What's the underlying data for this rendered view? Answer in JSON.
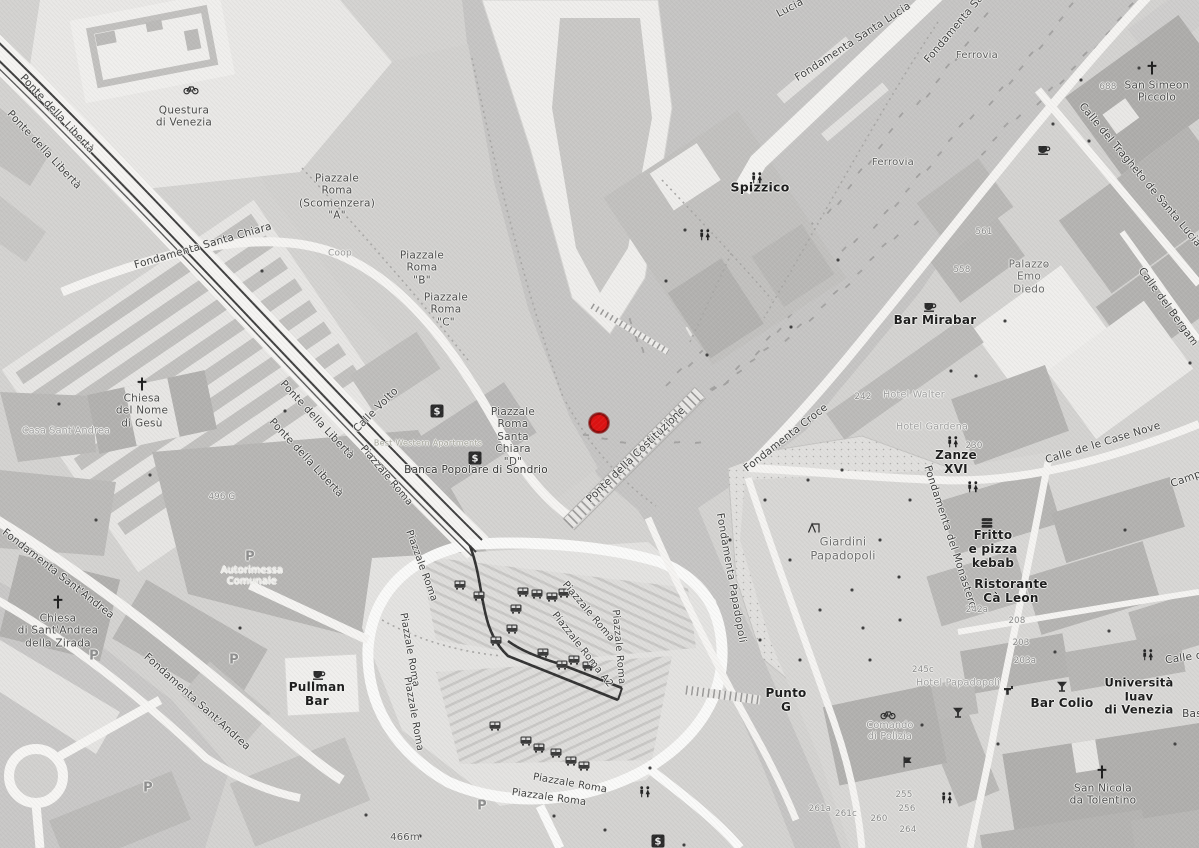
{
  "map": {
    "description": "Grayscale street map of Venice, Piazzale Roma and Santa Lucia area, with red location marker on the canal basin",
    "colors": {
      "land": "#d4d3d1",
      "water": "#c6c5c4",
      "building": "#b5b4b2",
      "building_light": "#efeeec",
      "road": "#f7f6f4",
      "park": "#e1e0de",
      "rail": "#404040",
      "marker_red": "#dd1212",
      "marker_ring": "#8f0b0b"
    },
    "marker": {
      "x": 599,
      "y": 423,
      "color": "#dd1212"
    },
    "scale_label": "466m",
    "labels": [
      {
        "t": "Lucia",
        "x": 790,
        "y": 8,
        "r": -28
      },
      {
        "t": "Fondamenta Santa Lucia",
        "x": 853,
        "y": 42,
        "r": -33
      },
      {
        "t": "Fondamenta Sa",
        "x": 954,
        "y": 29,
        "r": -50
      },
      {
        "t": "Ferrovia",
        "x": 977,
        "y": 56,
        "s": 10,
        "c": "#5a5a5a"
      },
      {
        "t": "Ferrovia",
        "x": 893,
        "y": 163,
        "s": 10,
        "c": "#5a5a5a"
      },
      {
        "t": "Spizzico",
        "x": 760,
        "y": 188,
        "s": 12.5,
        "w": 700,
        "c": "#1c1c1c"
      },
      {
        "t": "Questura\ndi Venezia",
        "x": 184,
        "y": 117,
        "c": "#4a4a4a"
      },
      {
        "t": "Piazzale\nRoma\n(Scomenzera)\n\"A\"",
        "x": 337,
        "y": 197,
        "c": "#4a4a4a"
      },
      {
        "t": "Piazzale\nRoma\n\"B\"",
        "x": 422,
        "y": 268,
        "c": "#4a4a4a"
      },
      {
        "t": "Piazzale\nRoma\n\"C\"",
        "x": 446,
        "y": 310,
        "c": "#4a4a4a"
      },
      {
        "t": "Piazzale\nRoma\nSanta\nChiara\n\"D\"",
        "x": 513,
        "y": 437,
        "c": "#4a4a4a"
      },
      {
        "t": "Fondamenta Santa Chiara",
        "x": 203,
        "y": 246,
        "r": -16
      },
      {
        "t": "Ponte della Libertà",
        "x": 57,
        "y": 114,
        "r": 47
      },
      {
        "t": "Ponte della Libertà",
        "x": 44,
        "y": 150,
        "r": 47
      },
      {
        "t": "Ponte della Libertà",
        "x": 317,
        "y": 420,
        "r": 47
      },
      {
        "t": "Ponte della Libertà",
        "x": 306,
        "y": 458,
        "r": 47
      },
      {
        "t": "Piazzale Roma",
        "x": 386,
        "y": 476,
        "r": 50,
        "s": 10
      },
      {
        "t": "Piazzale Roma",
        "x": 421,
        "y": 566,
        "r": 70,
        "s": 10
      },
      {
        "t": "Piazzale Roma",
        "x": 409,
        "y": 650,
        "r": 80,
        "s": 10
      },
      {
        "t": "Piazzale Roma",
        "x": 413,
        "y": 714,
        "r": 80,
        "s": 10
      },
      {
        "t": "Piazzale Roma",
        "x": 588,
        "y": 612,
        "r": 50,
        "s": 10
      },
      {
        "t": "Piazzale Roma A2",
        "x": 582,
        "y": 650,
        "r": 52,
        "s": 10
      },
      {
        "t": "Piazzale Roma",
        "x": 618,
        "y": 647,
        "r": 85,
        "s": 10
      },
      {
        "t": "Piazzale Roma",
        "x": 570,
        "y": 784,
        "r": 10,
        "s": 10
      },
      {
        "t": "Piazzale Roma",
        "x": 549,
        "y": 798,
        "r": 8,
        "s": 10
      },
      {
        "t": "Calle Volto",
        "x": 376,
        "y": 410,
        "r": -45
      },
      {
        "t": "Coop",
        "x": 340,
        "y": 254,
        "s": 9,
        "c": "#9a9a9a"
      },
      {
        "t": "Best Western Apartments",
        "x": 428,
        "y": 443,
        "s": 8,
        "c": "#a8a89e"
      },
      {
        "t": "Banca Popolare di Sondrio",
        "x": 476,
        "y": 470,
        "c": "#333333"
      },
      {
        "t": "Ponte della Costituzione",
        "x": 636,
        "y": 455,
        "r": -44
      },
      {
        "t": "Fondamenta Croce",
        "x": 786,
        "y": 438,
        "r": -38
      },
      {
        "t": "Fondamenta Papadopoli",
        "x": 731,
        "y": 578,
        "r": 80
      },
      {
        "t": "Fondamenta del Monastero",
        "x": 950,
        "y": 537,
        "r": 72
      },
      {
        "t": "Giardini\nPapadopoli",
        "x": 843,
        "y": 549,
        "s": 11.5,
        "c": "#6e6e6e"
      },
      {
        "t": "242",
        "x": 863,
        "y": 397,
        "s": 8.5,
        "c": "#8a8a8a"
      },
      {
        "t": "Hotel Walter",
        "x": 914,
        "y": 395,
        "s": 9.5,
        "c": "#a0a0a0"
      },
      {
        "t": "Hotel Gardena",
        "x": 932,
        "y": 427,
        "s": 9.5,
        "c": "#a0a0a0"
      },
      {
        "t": "Zanze\nXVI",
        "x": 956,
        "y": 462,
        "s": 12,
        "w": 700,
        "c": "#1c1c1c"
      },
      {
        "t": "230",
        "x": 974,
        "y": 446,
        "s": 8.5,
        "c": "#8a8a8a"
      },
      {
        "t": "Bar Mirabar",
        "x": 935,
        "y": 320,
        "s": 12,
        "w": 700,
        "c": "#1c1c1c"
      },
      {
        "t": "Palazzo\nEmo\nDiedo",
        "x": 1029,
        "y": 277,
        "c": "#6a6a6a"
      },
      {
        "t": "558",
        "x": 962,
        "y": 270,
        "s": 8.5,
        "c": "#8a8a8a"
      },
      {
        "t": "561",
        "x": 984,
        "y": 232,
        "s": 8.5,
        "c": "#8a8a8a"
      },
      {
        "t": "San Simeon\nPiccolo",
        "x": 1157,
        "y": 92,
        "c": "#4a4a4a"
      },
      {
        "t": "688",
        "x": 1108,
        "y": 87,
        "s": 8.5,
        "c": "#8a8a8a"
      },
      {
        "t": "Calle del Tragheto de Santa Lucia",
        "x": 1140,
        "y": 175,
        "r": 50
      },
      {
        "t": "Calle del Bergam",
        "x": 1168,
        "y": 307,
        "r": 54
      },
      {
        "t": "Calle de le Case Nove",
        "x": 1103,
        "y": 443,
        "r": -17
      },
      {
        "t": "Campo",
        "x": 1189,
        "y": 478,
        "r": -20
      },
      {
        "t": "Fritto\ne pizza\nkebab",
        "x": 993,
        "y": 549,
        "s": 12,
        "w": 700,
        "c": "#1c1c1c"
      },
      {
        "t": "Ristorante\nCà Leon",
        "x": 1011,
        "y": 591,
        "s": 12,
        "w": 700,
        "c": "#1c1c1c"
      },
      {
        "t": "242a",
        "x": 977,
        "y": 610,
        "s": 8.5,
        "c": "#8a8a8a"
      },
      {
        "t": "Università\nIuav\ndi Venezia",
        "x": 1139,
        "y": 697,
        "s": 11.5,
        "w": 700,
        "c": "#1c1c1c"
      },
      {
        "t": "Bar Colio",
        "x": 1062,
        "y": 703,
        "s": 12,
        "w": 700,
        "c": "#1c1c1c"
      },
      {
        "t": "San Nicola\nda Tolentino",
        "x": 1103,
        "y": 795,
        "c": "#4a4a4a"
      },
      {
        "t": "Hotel Papadopoli",
        "x": 958,
        "y": 683,
        "s": 9.5,
        "c": "#a0a0a0"
      },
      {
        "t": "245c",
        "x": 923,
        "y": 670,
        "s": 8.5,
        "c": "#8a8a8a"
      },
      {
        "t": "Punto\nG",
        "x": 786,
        "y": 700,
        "s": 12,
        "w": 700,
        "c": "#1c1c1c"
      },
      {
        "t": "Comando\ndi Polizia",
        "x": 890,
        "y": 731,
        "s": 9.5,
        "c": "#9a9a9a"
      },
      {
        "t": "261a",
        "x": 820,
        "y": 809,
        "s": 8.5,
        "c": "#8a8a8a"
      },
      {
        "t": "261c",
        "x": 846,
        "y": 814,
        "s": 8.5,
        "c": "#8a8a8a"
      },
      {
        "t": "260",
        "x": 879,
        "y": 819,
        "s": 8.5,
        "c": "#8a8a8a"
      },
      {
        "t": "255",
        "x": 904,
        "y": 795,
        "s": 8.5,
        "c": "#8a8a8a"
      },
      {
        "t": "256",
        "x": 907,
        "y": 809,
        "s": 8.5,
        "c": "#8a8a8a"
      },
      {
        "t": "264",
        "x": 908,
        "y": 830,
        "s": 8.5,
        "c": "#8a8a8a"
      },
      {
        "t": "208",
        "x": 1017,
        "y": 621,
        "s": 8.5,
        "c": "#8a8a8a"
      },
      {
        "t": "203",
        "x": 1021,
        "y": 643,
        "s": 8.5,
        "c": "#8a8a8a"
      },
      {
        "t": "203a",
        "x": 1025,
        "y": 661,
        "s": 8.5,
        "c": "#8a8a8a"
      },
      {
        "t": "Chiesa\ndel Nome\ndi Gesù",
        "x": 142,
        "y": 411,
        "c": "#4a4a4a"
      },
      {
        "t": "Casa Sant'Andrea",
        "x": 66,
        "y": 431,
        "s": 9.5,
        "c": "#a0a0a0"
      },
      {
        "t": "496 G",
        "x": 222,
        "y": 497,
        "s": 8.5,
        "c": "#8a8a8a"
      },
      {
        "t": "Fondamenta Sant'Andrea",
        "x": 58,
        "y": 574,
        "r": 38
      },
      {
        "t": "Fondamenta Sant'Andrea",
        "x": 197,
        "y": 702,
        "r": 42
      },
      {
        "t": "Chiesa\ndi Sant'Andrea\ndella Zirada",
        "x": 58,
        "y": 631,
        "c": "#4a4a4a"
      },
      {
        "t": "Autorimessa\nComunale",
        "x": 252,
        "y": 576,
        "s": 9.5,
        "c": "#f0efec"
      },
      {
        "t": "Pullman\nBar",
        "x": 317,
        "y": 694,
        "s": 12,
        "w": 700,
        "c": "#1c1c1c"
      },
      {
        "t": "466m",
        "x": 405,
        "y": 838,
        "s": 10,
        "c": "#555555"
      },
      {
        "t": "Bas",
        "x": 1192,
        "y": 714
      },
      {
        "t": "Calle d",
        "x": 1184,
        "y": 658,
        "r": -8
      },
      {
        "t": "P",
        "x": 250,
        "y": 557,
        "s": 13,
        "w": 700,
        "c": "#8f8f8f"
      },
      {
        "t": "P",
        "x": 234,
        "y": 660,
        "s": 13,
        "w": 700,
        "c": "#8f8f8f"
      },
      {
        "t": "P",
        "x": 94,
        "y": 656,
        "s": 13,
        "w": 700,
        "c": "#8f8f8f"
      },
      {
        "t": "P",
        "x": 148,
        "y": 788,
        "s": 13,
        "w": 700,
        "c": "#8f8f8f"
      },
      {
        "t": "P",
        "x": 482,
        "y": 806,
        "s": 13,
        "w": 700,
        "c": "#8f8f8f"
      }
    ],
    "icons": [
      {
        "t": "cross",
        "x": 142,
        "y": 384
      },
      {
        "t": "cross",
        "x": 58,
        "y": 602
      },
      {
        "t": "cross",
        "x": 1152,
        "y": 68
      },
      {
        "t": "cross",
        "x": 1102,
        "y": 772
      },
      {
        "t": "bank",
        "x": 437,
        "y": 411
      },
      {
        "t": "bank",
        "x": 475,
        "y": 458
      },
      {
        "t": "bank",
        "x": 658,
        "y": 841
      },
      {
        "t": "cafe",
        "x": 930,
        "y": 306
      },
      {
        "t": "cafe",
        "x": 319,
        "y": 674
      },
      {
        "t": "cafe",
        "x": 1044,
        "y": 149
      },
      {
        "t": "restroom",
        "x": 757,
        "y": 178
      },
      {
        "t": "restroom",
        "x": 705,
        "y": 235
      },
      {
        "t": "restroom",
        "x": 953,
        "y": 442
      },
      {
        "t": "restroom",
        "x": 973,
        "y": 487
      },
      {
        "t": "restroom",
        "x": 1148,
        "y": 655
      },
      {
        "t": "restroom",
        "x": 947,
        "y": 798
      },
      {
        "t": "restroom",
        "x": 645,
        "y": 792
      },
      {
        "t": "bicycle",
        "x": 191,
        "y": 89
      },
      {
        "t": "bicycle",
        "x": 888,
        "y": 714
      },
      {
        "t": "cocktail",
        "x": 1062,
        "y": 687
      },
      {
        "t": "cocktail",
        "x": 958,
        "y": 713
      },
      {
        "t": "burger",
        "x": 987,
        "y": 523
      },
      {
        "t": "playground",
        "x": 814,
        "y": 528
      },
      {
        "t": "tap",
        "x": 1009,
        "y": 690
      },
      {
        "t": "flag",
        "x": 907,
        "y": 762
      },
      {
        "t": "bus",
        "x": 523,
        "y": 592
      },
      {
        "t": "bus",
        "x": 537,
        "y": 594
      },
      {
        "t": "bus",
        "x": 552,
        "y": 597
      },
      {
        "t": "bus",
        "x": 564,
        "y": 593
      },
      {
        "t": "bus",
        "x": 516,
        "y": 609
      },
      {
        "t": "bus",
        "x": 512,
        "y": 629
      },
      {
        "t": "bus",
        "x": 496,
        "y": 641
      },
      {
        "t": "bus",
        "x": 543,
        "y": 653
      },
      {
        "t": "bus",
        "x": 562,
        "y": 665
      },
      {
        "t": "bus",
        "x": 574,
        "y": 660
      },
      {
        "t": "bus",
        "x": 588,
        "y": 666
      },
      {
        "t": "bus",
        "x": 495,
        "y": 726
      },
      {
        "t": "bus",
        "x": 526,
        "y": 741
      },
      {
        "t": "bus",
        "x": 539,
        "y": 748
      },
      {
        "t": "bus",
        "x": 556,
        "y": 753
      },
      {
        "t": "bus",
        "x": 571,
        "y": 761
      },
      {
        "t": "bus",
        "x": 584,
        "y": 766
      },
      {
        "t": "bus",
        "x": 460,
        "y": 585
      },
      {
        "t": "bus",
        "x": 479,
        "y": 596
      }
    ],
    "decor_dots": [
      [
        59,
        404
      ],
      [
        285,
        411
      ],
      [
        262,
        271
      ],
      [
        685,
        230
      ],
      [
        707,
        355
      ],
      [
        666,
        281
      ],
      [
        791,
        327
      ],
      [
        838,
        260
      ],
      [
        951,
        371
      ],
      [
        1005,
        321
      ],
      [
        1046,
        266
      ],
      [
        1089,
        141
      ],
      [
        1139,
        68
      ],
      [
        976,
        376
      ],
      [
        730,
        540
      ],
      [
        808,
        480
      ],
      [
        863,
        628
      ],
      [
        899,
        577
      ],
      [
        922,
        725
      ],
      [
        998,
        744
      ],
      [
        1055,
        652
      ],
      [
        1109,
        631
      ],
      [
        1175,
        744
      ],
      [
        1125,
        530
      ],
      [
        1190,
        363
      ],
      [
        650,
        768
      ],
      [
        605,
        830
      ],
      [
        684,
        845
      ],
      [
        554,
        816
      ],
      [
        420,
        836
      ],
      [
        366,
        815
      ],
      [
        240,
        628
      ],
      [
        150,
        475
      ],
      [
        96,
        520
      ],
      [
        765,
        500
      ],
      [
        790,
        560
      ],
      [
        820,
        610
      ],
      [
        852,
        590
      ],
      [
        880,
        540
      ],
      [
        842,
        470
      ],
      [
        900,
        620
      ],
      [
        760,
        640
      ],
      [
        800,
        660
      ],
      [
        870,
        660
      ],
      [
        910,
        500
      ],
      [
        930,
        470
      ],
      [
        1081,
        80
      ],
      [
        1053,
        124
      ]
    ]
  }
}
